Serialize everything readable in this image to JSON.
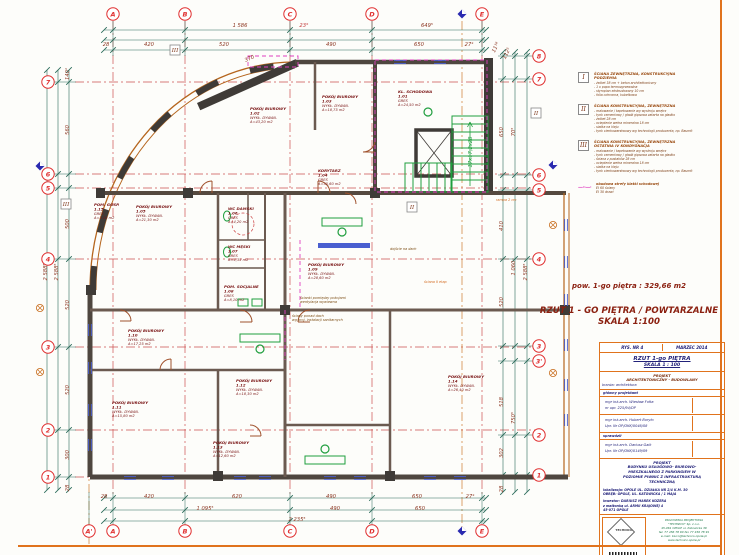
{
  "summary": {
    "area_line": "pow. 1-go piętra : 329,66 m2",
    "title_line1": "RZUT  1 - GO PIĘTRA / POWTARZALNE",
    "title_line2": "SKALA 1:100"
  },
  "legend": {
    "items": [
      {
        "symbol": "I",
        "title_lines": [
          "ŚCIANA ZEWNĘTRZNA, KONSTRUKCYJNA",
          "PODZIEMIA"
        ],
        "bullets": [
          "żelbet 38 cm + beton architektoniczny",
          "1 x papa termozgrzewalna",
          "styropian ekstrudowany 10 cm",
          "folia ochronna, kubełkowa"
        ]
      },
      {
        "symbol": "II",
        "title_lines": [
          "ŚCIANA KONSTRUKCYJNA, ZEWNĘTRZNA"
        ],
        "bullets": [
          "malowanie / tapetowanie wg wystroju wnętrz",
          "tynk cementowy / gładź gipsowa zatarta na gładko",
          "żelbet 28 cm",
          "ocieplenie wełna mineralna 18 cm",
          "siatka na kleju",
          "tynk cienkowarstwowy wg technologii producenta, np. Baumit"
        ]
      },
      {
        "symbol": "III",
        "title_lines": [
          "ŚCIANA KONSTRUKCYJNA, ZEWNĘTRZNA",
          "OSTATNIA IV KONDYGNACJA"
        ],
        "bullets": [
          "malowanie / tapetowanie wg wystroju wnętrz",
          "tynk cementowy / gładź gipsowa zatarta na gładko",
          "ściana z pustaków 28 cm",
          "ocieplenie wełna mineralna 18 cm",
          "siatka na kleju",
          "tynk cienkowarstwowy wg technologii producenta, np. Baumit"
        ]
      }
    ],
    "fire_note": {
      "dash": "—··—·",
      "line1": "obudowa strefy klatki schodowej",
      "line2": "EI 60  ściany",
      "line3": "EI 30  drzwi"
    }
  },
  "title_block": {
    "drawing_no": "RYS. NR  4",
    "date": "MARZEC 2014",
    "drawing_title": "RZUT  1-go PIĘTRA",
    "scale": "SKALA 1 : 100",
    "project_kind1": "PROJEKT",
    "project_kind2": "ARCHITEKTONICZNY - BUDOWLANY",
    "branch": "branża: architektura",
    "role_main": "główny projektant",
    "person1_name": "mgr inż.arch. Wiesław Fołta",
    "person1_lic": "nr upr. 225/94/OP",
    "person2_name": "mgr inż.arch. Hubert Boryło",
    "person2_lic": "Upr. Nr OP/OKK/0046/08",
    "role_check": "sprawdził",
    "person3_name": "mgr inż.arch. Dariusz  Gaik",
    "person3_lic": "Upr. Nr OP/OKK/0149/09",
    "desc_title": "PROJEKT",
    "desc_body1": "BUDYNKU USŁUGOWO- BIUROWO-",
    "desc_body2": "MIESZKALNEGO Z PARKINGIEM W",
    "desc_body3": "POZIOMIE  PIWNIC  Z INFRASTRUKTURĄ",
    "desc_body4": "TECHNICZNĄ",
    "location1": "lokalizacja:  OPOLE UL. DZIAŁKA NR 2/4  K.M. 30",
    "location2": "OBRĘB:  OPOLE, UL. KATOWICKA  / 1 MAJA",
    "investor1": "inwestor:   DARIUSZ  MAREK  KOZERA",
    "investor2": "z małżonką  ul. ARMII KRAJOWEJ 4",
    "investor3": "45-071  OPOLE",
    "logo_name": "TECHNICO",
    "company_lines": [
      "PRACOWNIA PROJEKTOWA",
      "\"TECHNICO\" Sp. z o.o.",
      "45-061 OPOLE ul. Katowicka 39",
      "tel. 77 456 78 90  fax 77 456 78 91",
      "e-mail: biuro@technico.opole.pl",
      "www.technico.opole.pl"
    ]
  },
  "plan": {
    "axes_top": [
      {
        "label": "A",
        "x": 113
      },
      {
        "label": "B",
        "x": 185
      },
      {
        "label": "C",
        "x": 290
      },
      {
        "label": "D",
        "x": 372
      },
      {
        "label": "E",
        "x": 482
      }
    ],
    "axes_bottom": [
      {
        "label": "A'",
        "x": 89
      },
      {
        "label": "A",
        "x": 113
      },
      {
        "label": "B",
        "x": 185
      },
      {
        "label": "C",
        "x": 290
      },
      {
        "label": "D",
        "x": 372
      },
      {
        "label": "E",
        "x": 482
      }
    ],
    "axes_left": [
      {
        "label": "7",
        "y": 82
      },
      {
        "label": "6",
        "y": 174
      },
      {
        "label": "5",
        "y": 188
      },
      {
        "label": "4",
        "y": 259
      },
      {
        "label": "3",
        "y": 347
      },
      {
        "label": "2",
        "y": 430
      },
      {
        "label": "1",
        "y": 477
      }
    ],
    "axes_right": [
      {
        "label": "8",
        "y": 56
      },
      {
        "label": "7",
        "y": 79
      },
      {
        "label": "6",
        "y": 175
      },
      {
        "label": "5",
        "y": 190
      },
      {
        "label": "4",
        "y": 259
      },
      {
        "label": "3",
        "y": 346
      },
      {
        "label": "3'",
        "y": 361
      },
      {
        "label": "2",
        "y": 435
      },
      {
        "label": "1",
        "y": 475
      }
    ],
    "dims": [
      {
        "t": "1 586",
        "x": 240,
        "y": 27
      },
      {
        "t": "649⁵",
        "x": 427,
        "y": 27
      },
      {
        "t": "23°",
        "x": 304,
        "y": 27,
        "cls": "red"
      },
      {
        "t": "28",
        "x": 106,
        "y": 46
      },
      {
        "t": "420",
        "x": 149,
        "y": 46
      },
      {
        "t": "520",
        "x": 224,
        "y": 46
      },
      {
        "t": "490",
        "x": 331,
        "y": 46
      },
      {
        "t": "650",
        "x": 419,
        "y": 46
      },
      {
        "t": "27⁴",
        "x": 469,
        "y": 46
      },
      {
        "t": "370",
        "x": 250,
        "y": 60,
        "rot": -24
      },
      {
        "t": "28",
        "x": 104,
        "y": 498
      },
      {
        "t": "420",
        "x": 149,
        "y": 498
      },
      {
        "t": "620",
        "x": 237,
        "y": 498
      },
      {
        "t": "490",
        "x": 331,
        "y": 498
      },
      {
        "t": "650",
        "x": 417,
        "y": 498
      },
      {
        "t": "27⁴",
        "x": 470,
        "y": 498
      },
      {
        "t": "1 095⁵",
        "x": 205,
        "y": 510
      },
      {
        "t": "490",
        "x": 335,
        "y": 510
      },
      {
        "t": "650",
        "x": 420,
        "y": 510
      },
      {
        "t": "2 235⁵",
        "x": 297,
        "y": 521
      },
      {
        "t": "140¹",
        "x": 69,
        "y": 74,
        "rot": -90
      },
      {
        "t": "560",
        "x": 69,
        "y": 130,
        "rot": -90
      },
      {
        "t": "500",
        "x": 69,
        "y": 224,
        "rot": -90
      },
      {
        "t": "520",
        "x": 69,
        "y": 305,
        "rot": -90
      },
      {
        "t": "520",
        "x": 69,
        "y": 390,
        "rot": -90
      },
      {
        "t": "300",
        "x": 69,
        "y": 455,
        "rot": -90
      },
      {
        "t": "28",
        "x": 69,
        "y": 488,
        "rot": -90
      },
      {
        "t": "2 588⁵",
        "x": 58,
        "y": 272,
        "rot": -90
      },
      {
        "t": "2 588⁵",
        "x": 47,
        "y": 272,
        "rot": -90
      },
      {
        "t": "11¹⁸",
        "x": 497,
        "y": 48,
        "rot": -65
      },
      {
        "t": "112⁵",
        "x": 508,
        "y": 54,
        "rot": -65
      },
      {
        "t": "650",
        "x": 503,
        "y": 132,
        "rot": -90
      },
      {
        "t": "70⁵",
        "x": 515,
        "y": 132,
        "rot": -90
      },
      {
        "t": "410",
        "x": 503,
        "y": 226,
        "rot": -90
      },
      {
        "t": "1 060",
        "x": 515,
        "y": 268,
        "rot": -90
      },
      {
        "t": "520",
        "x": 503,
        "y": 302,
        "rot": -90
      },
      {
        "t": "2 588⁵",
        "x": 527,
        "y": 272,
        "rot": -90
      },
      {
        "t": "518",
        "x": 503,
        "y": 402,
        "rot": -90
      },
      {
        "t": "750⁵",
        "x": 515,
        "y": 418,
        "rot": -90
      },
      {
        "t": "302",
        "x": 503,
        "y": 453,
        "rot": -90
      },
      {
        "t": "28",
        "x": 503,
        "y": 489,
        "rot": -90
      },
      {
        "t": "17x17,2x28",
        "x": 472,
        "y": 152,
        "rot": -90,
        "cls": "green"
      }
    ],
    "rooms": [
      {
        "name": "KL. SCHODOWA",
        "num": "1.01",
        "finish": "GRES",
        "area": "A=24,50 m2",
        "x": 398,
        "y": 93
      },
      {
        "name": "POKÓJ BIUROWY",
        "num": "1.02",
        "finish": "WYKŁ. DYWAN.",
        "area": "A=43,20 m2",
        "x": 250,
        "y": 110
      },
      {
        "name": "POKÓJ BIUROWY",
        "num": "1.03",
        "finish": "WYKŁ. DYWAN.",
        "area": "A=18,75 m2",
        "x": 322,
        "y": 98
      },
      {
        "name": "KORYTARZ",
        "num": "1.04",
        "finish": "GRES",
        "area": "A=35,60 m2",
        "x": 318,
        "y": 172
      },
      {
        "name": "POKÓJ BIUROWY",
        "num": "1.05",
        "finish": "WYKŁ. DYWAN.",
        "area": "A=21,30 m2",
        "x": 136,
        "y": 208
      },
      {
        "name": "WC DAMSKI",
        "num": "1.06",
        "finish": "GRES",
        "area": "A=4,20 m2",
        "x": 228,
        "y": 210
      },
      {
        "name": "WC MĘSKI",
        "num": "1.07",
        "finish": "GRES",
        "area": "A=4,35 m2",
        "x": 228,
        "y": 248
      },
      {
        "name": "POM. SOCJALNE",
        "num": "1.08",
        "finish": "GRES",
        "area": "A=8,10 m2",
        "x": 224,
        "y": 288
      },
      {
        "name": "POKÓJ BIUROWY",
        "num": "1.09",
        "finish": "WYKŁ. DYWAN.",
        "area": "A=28,60 m2",
        "x": 308,
        "y": 266
      },
      {
        "name": "POKÓJ BIUROWY",
        "num": "1.10",
        "finish": "WYKŁ. DYWAN.",
        "area": "A=17,25 m2",
        "x": 128,
        "y": 332
      },
      {
        "name": "POKÓJ BIUROWY",
        "num": "1.11",
        "finish": "WYKŁ. DYWAN.",
        "area": "A=15,80 m2",
        "x": 112,
        "y": 404
      },
      {
        "name": "POKÓJ BIUROWY",
        "num": "1.12",
        "finish": "WYKŁ. DYWAN.",
        "area": "A=18,30 m2",
        "x": 236,
        "y": 382
      },
      {
        "name": "POKÓJ BIUROWY",
        "num": "1.13",
        "finish": "WYKŁ. DYWAN.",
        "area": "A=12,60 m2",
        "x": 213,
        "y": 444
      },
      {
        "name": "POKÓJ BIUROWY",
        "num": "1.14",
        "finish": "WYKŁ. DYWAN.",
        "area": "A=26,40 m2",
        "x": 448,
        "y": 378
      },
      {
        "name": "POM. GOSP.",
        "num": "1.15",
        "finish": "GRES",
        "area": "A=3,10 m2",
        "x": 94,
        "y": 206
      }
    ],
    "notes": [
      {
        "lines": [
          "ścianki pomiędzy pokojami",
          "wentylacja wywiewna"
        ],
        "x": 300,
        "y": 299,
        "c": "#7a4a10"
      },
      {
        "lines": [
          "ściany ponad dach",
          "wg proj. instalacji sanitarnych"
        ],
        "x": 292,
        "y": 317,
        "c": "#7a4a10"
      },
      {
        "lines": [
          "rampa 2 cm"
        ],
        "x": 496,
        "y": 201,
        "c": "#d2691e"
      },
      {
        "lines": [
          "ściana II etap"
        ],
        "x": 424,
        "y": 283,
        "c": "#d2691e"
      },
      {
        "lines": [
          "dojście na dach"
        ],
        "x": 390,
        "y": 250,
        "c": "#7a4a10"
      }
    ],
    "wall_marks": [
      {
        "t": "III",
        "x": 175,
        "y": 50
      },
      {
        "t": "II",
        "x": 536,
        "y": 113
      },
      {
        "t": "II",
        "x": 412,
        "y": 207
      },
      {
        "t": "III",
        "x": 66,
        "y": 204
      }
    ],
    "windows_h": [
      [
        130,
        478
      ],
      [
        168,
        478
      ],
      [
        240,
        478
      ],
      [
        265,
        478
      ],
      [
        330,
        478
      ],
      [
        360,
        478
      ],
      [
        430,
        478
      ],
      [
        460,
        478
      ],
      [
        400,
        62
      ],
      [
        440,
        62
      ]
    ],
    "windows_v": [
      [
        566,
        225
      ],
      [
        566,
        262
      ],
      [
        566,
        300
      ],
      [
        566,
        345
      ],
      [
        566,
        385
      ],
      [
        566,
        420
      ],
      [
        90,
        330
      ],
      [
        90,
        368
      ],
      [
        90,
        410
      ],
      [
        90,
        445
      ]
    ],
    "blue_marks": [
      [
        462,
        14
      ],
      [
        462,
        531
      ],
      [
        40,
        166
      ],
      [
        553,
        165
      ]
    ],
    "orange_marks": [
      [
        40,
        308
      ],
      [
        40,
        372
      ],
      [
        553,
        225
      ],
      [
        553,
        373
      ]
    ]
  }
}
